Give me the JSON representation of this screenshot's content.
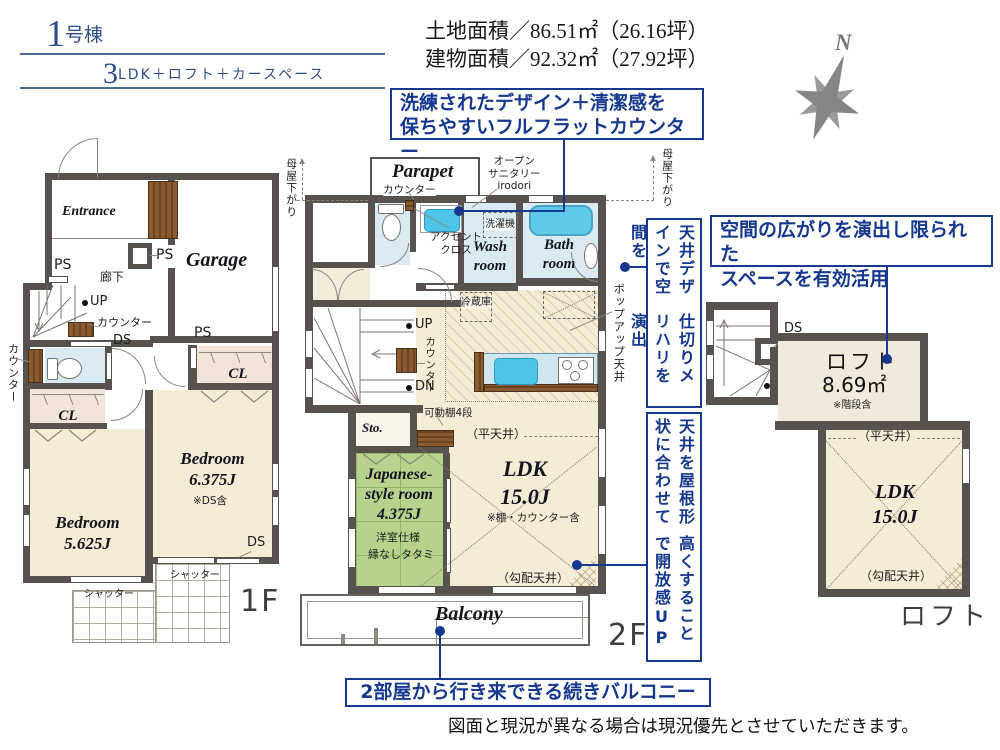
{
  "colors": {
    "accent_navy": "#16388f",
    "title_blue": "#2d4e86",
    "wall_gray": "#57524d",
    "floor_cream": "#f5ecd6",
    "tatami_green": "#b6d28d",
    "water_blue": "#d9eaf2",
    "tub_blue": "#5ec9e9",
    "closet_pink": "#f3e4d9",
    "wood_brown": "#8a5a30"
  },
  "header": {
    "unit_number": "1",
    "unit_suffix": "号棟",
    "plan_number": "3",
    "plan_suffix": "LDK＋ロフト＋カースペース",
    "land_area": "土地面積／86.51㎡（26.16坪）",
    "building_area": "建物面積／92.32㎡（27.92坪）",
    "north": "N"
  },
  "annotations": {
    "flat_counter_line1": "洗練されたデザイン＋清潔感を",
    "flat_counter_line2": "保ちやすいフルフラットカウンター",
    "loft_space_line1": "空間の広がりを演出し限られた",
    "loft_space_line2": "スペースを有効活用",
    "ceiling_design_col1": "天井デザインで空間を",
    "ceiling_design_col2": "仕切りメリハリを演出",
    "ceiling_height_col1": "天井を屋根形状に合わせて",
    "ceiling_height_col2": "高くすることで開放感UP",
    "balcony_note": "2部屋から行き来できる続きバルコニー",
    "disclaimer": "図面と現況が異なる場合は現況優先とさせていただきます。"
  },
  "common": {
    "ps": "PS",
    "ds": "DS",
    "cl": "CL",
    "up": "UP",
    "dn": "DN",
    "counter": "カウンター",
    "shutter": "シャッター",
    "moya": "母屋下がり",
    "flat_ceiling": "（平天井）",
    "sloped_ceiling": "（勾配天井）"
  },
  "floor1": {
    "entrance": "Entrance",
    "garage": "Garage",
    "hallway": "廊下",
    "bedroom1_name": "Bedroom",
    "bedroom1_size": "5.625J",
    "bedroom2_name": "Bedroom",
    "bedroom2_size": "6.375J",
    "bedroom2_note": "※DS含",
    "label": "1F"
  },
  "floor2": {
    "parapet": "Parapet",
    "open_sanitary_line1": "オープン",
    "open_sanitary_line2": "サニタリー",
    "open_sanitary_line3": "irodori",
    "washer": "洗濯機",
    "accent_line1": "アクセント",
    "accent_line2": "クロス",
    "wash_line1": "Wash",
    "wash_line2": "room",
    "bath_line1": "Bath",
    "bath_line2": "room",
    "fridge": "冷蔵庫",
    "popup_ceiling": "ポップアップ天井",
    "shelf": "可動棚4段",
    "storage": "Sto.",
    "ldk_name": "LDK",
    "ldk_size": "15.0J",
    "ldk_note": "※棚・カウンター含",
    "jp_line1": "Japanese-",
    "jp_line2": "style room",
    "jp_size": "4.375J",
    "jp_note1": "洋室仕様",
    "jp_note2": "縁なしタタミ",
    "balcony": "Balcony",
    "label": "2F"
  },
  "loft": {
    "name": "ロフト",
    "size": "8.69㎡",
    "note": "※階段含",
    "ldk_name": "LDK",
    "ldk_size": "15.0J",
    "label": "ロフト"
  }
}
